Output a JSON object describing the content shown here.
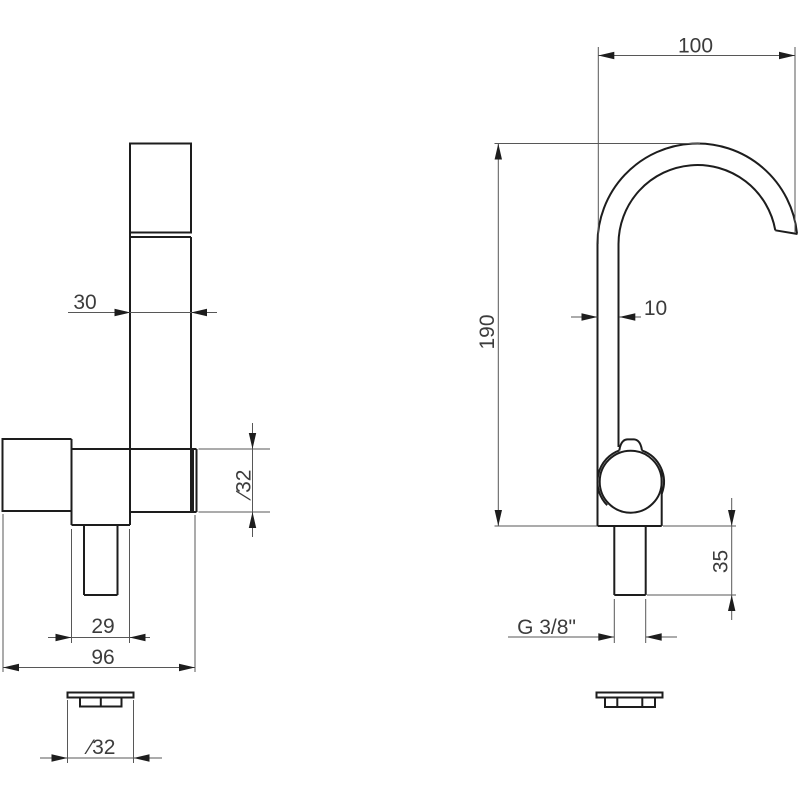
{
  "colors": {
    "background": "#ffffff",
    "outline": "#1d1d1d",
    "dimension_lines": "#575757",
    "text": "#3c3c3c"
  },
  "views": {
    "side_view": {
      "dimensions": {
        "spout_tube_width": "30",
        "body_diameter": "∕32",
        "valve_offset": "29",
        "overall_length": "96",
        "base_diameter": "∕32"
      }
    },
    "front_view": {
      "dimensions": {
        "spout_reach": "100",
        "spout_height": "190",
        "spout_tube": "10",
        "shank_length": "35",
        "thread": "G 3/8\""
      }
    }
  }
}
